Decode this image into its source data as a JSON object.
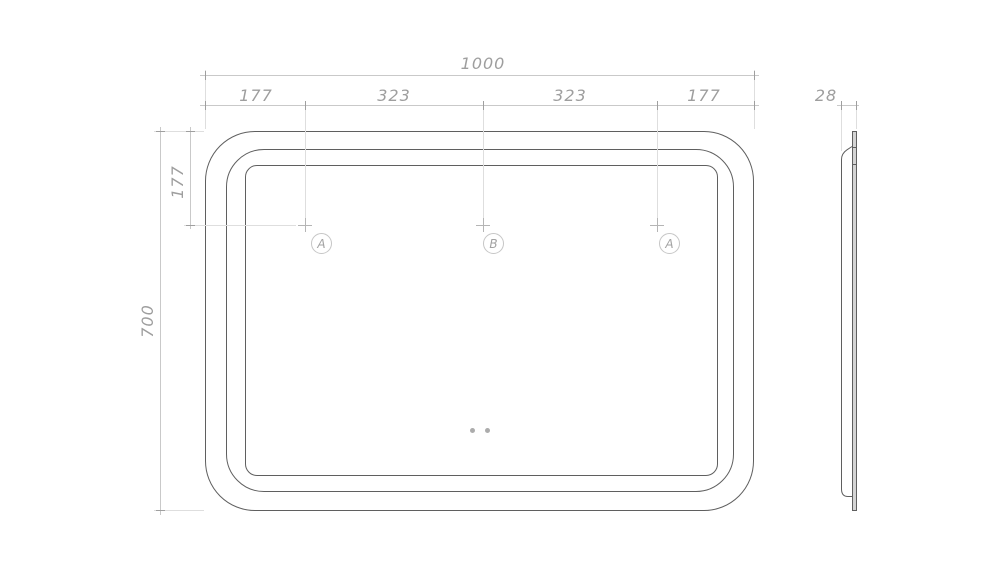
{
  "dimensions": {
    "overall_width": "1000",
    "top_segments": [
      "177",
      "323",
      "323",
      "177"
    ],
    "overall_height": "700",
    "top_offset": "177",
    "side_depth": "28"
  },
  "markers": [
    {
      "label": "A"
    },
    {
      "label": "B"
    },
    {
      "label": "A"
    }
  ],
  "colors": {
    "outline": "#5f5f5f",
    "dimension_line": "#c9c9c9",
    "extension_line": "#dedede",
    "text": "#9e9e9e"
  }
}
